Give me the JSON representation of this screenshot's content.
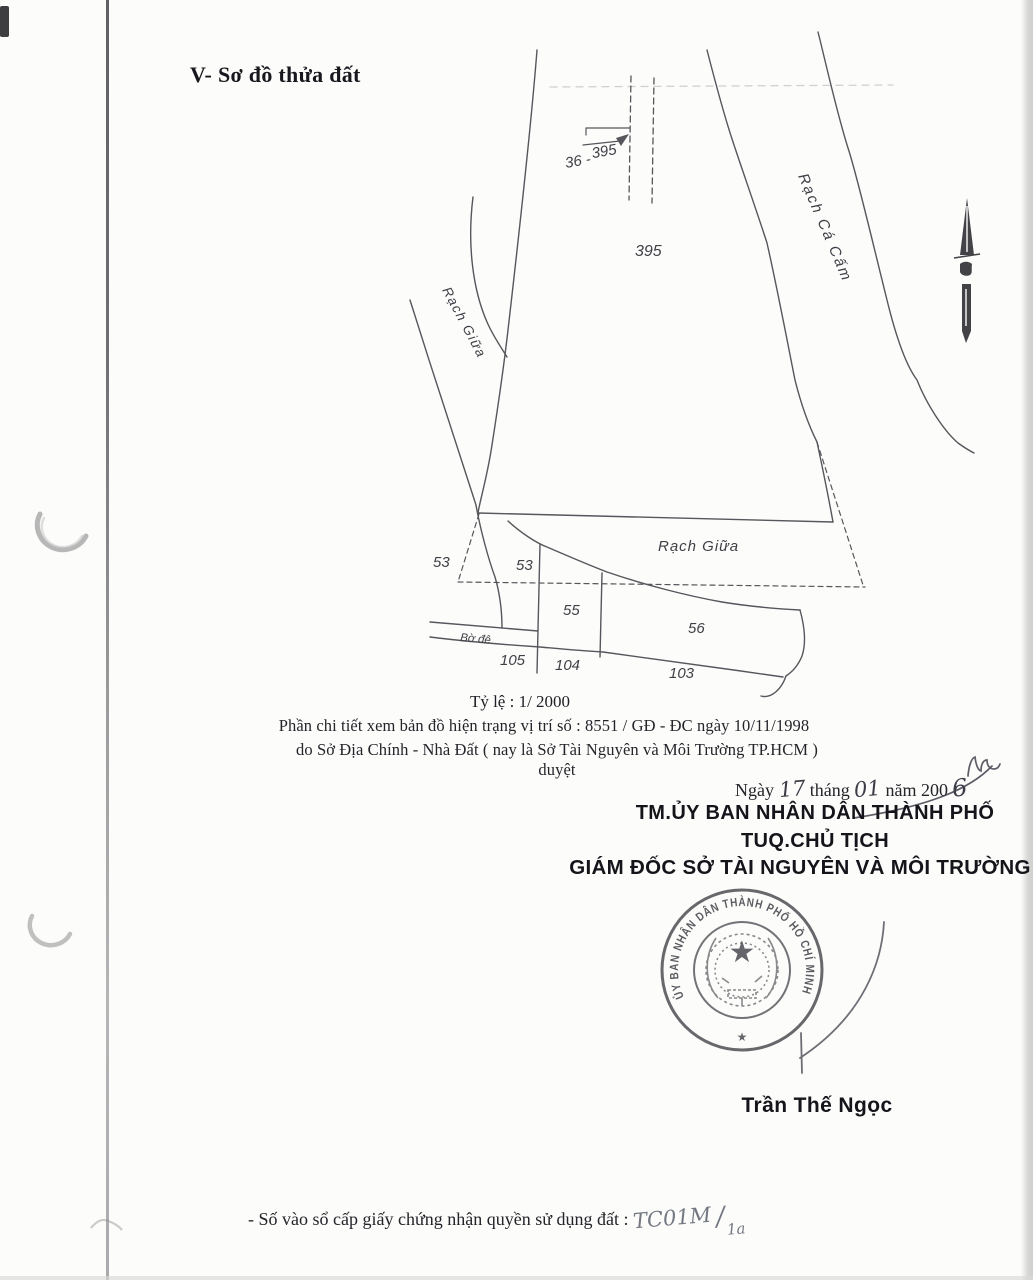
{
  "page": {
    "section_title": "V- Sơ đồ thửa đất",
    "scale_label": "Tỷ lệ : 1/ 2000",
    "note_line1": "Phần chi tiết xem bản đồ hiện trạng vị trí số : 8551 / GĐ - ĐC ngày 10/11/1998",
    "note_line2": "do Sở Địa Chính - Nhà Đất ( nay là Sở Tài Nguyên và Môi Trường TP.HCM ) duyệt"
  },
  "map": {
    "labels": {
      "sheet_ref_a": "36 -",
      "sheet_ref_b": "395",
      "parcel_main": "395",
      "canal_right": "Rạch Cá Cấm",
      "canal_left": "Rạch Giữa",
      "canal_mid": "Rạch Giữa",
      "parcel_53_outer": "53",
      "parcel_53": "53",
      "parcel_55": "55",
      "parcel_56": "56",
      "dike": "Bờ đê",
      "lot_105": "105",
      "lot_104": "104",
      "lot_103": "103"
    }
  },
  "signing": {
    "date_word_day": "Ngày",
    "date_day": "17",
    "date_word_month": "tháng",
    "date_month": "01",
    "date_word_year": "năm 200",
    "date_year_digit": "6",
    "org_line1": "TM.ỦY BAN NHÂN DÂN THÀNH PHỐ",
    "org_line2": "TUQ.CHỦ TỊCH",
    "org_line3": "GIÁM ĐỐC SỞ TÀI NGUYÊN VÀ MÔI TRƯỜNG",
    "signer_name": "Trần Thế Ngọc",
    "stamp_text": "ỦY BAN NHÂN DÂN THÀNH PHỐ HỒ CHÍ MINH",
    "stamp_star": "★"
  },
  "footer": {
    "register_label": "- Số vào sổ cấp giấy chứng nhận quyền sử dụng đất : ",
    "register_number": "TC01M",
    "register_separator": "/",
    "register_suffix": "1a"
  },
  "colors": {
    "ink": "#1d1d24",
    "map_line": "#56565c",
    "stamp_ink": "#3d3d44",
    "handwriting_ink": "#4a4a55"
  }
}
